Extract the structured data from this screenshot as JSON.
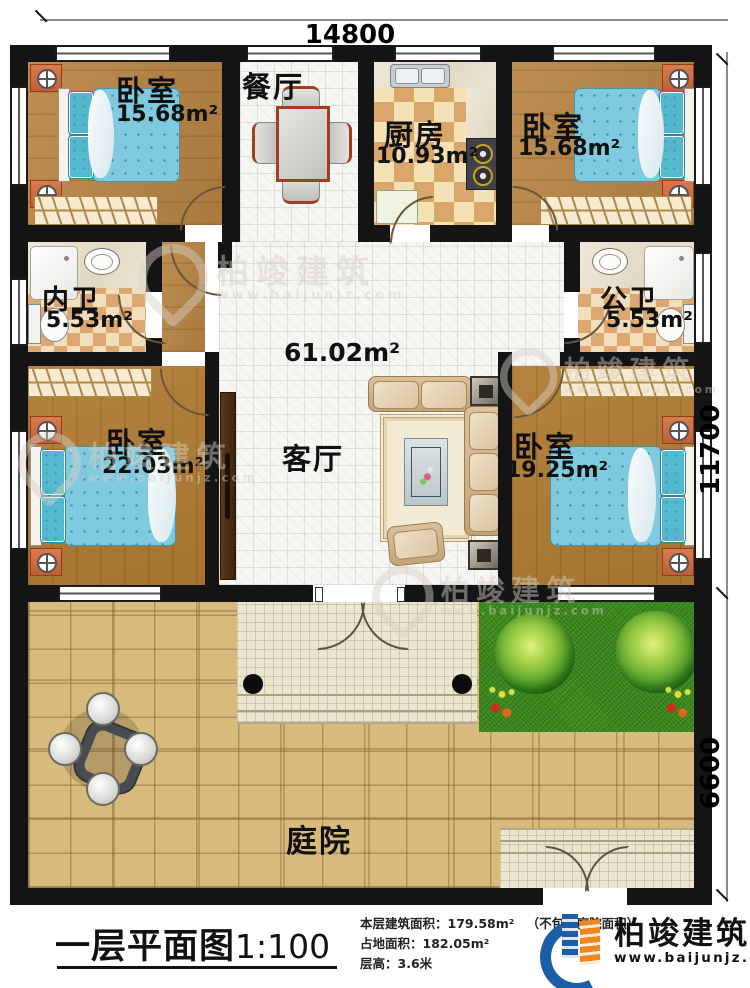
{
  "plan": {
    "title": "一层平面图",
    "scale": "1:100"
  },
  "dimensions": {
    "top_width": "14800",
    "right_upper": "11700",
    "right_lower": "6600"
  },
  "rooms": [
    {
      "id": "bedroom-top-left",
      "label": "卧室",
      "area": "15.68m²"
    },
    {
      "id": "dining-room",
      "label": "餐厅",
      "area": ""
    },
    {
      "id": "kitchen",
      "label": "厨房",
      "area": "10.93m²"
    },
    {
      "id": "bedroom-top-right",
      "label": "卧室",
      "area": "15.68m²"
    },
    {
      "id": "bath-private",
      "label": "内卫",
      "area": "5.53m²"
    },
    {
      "id": "bath-public",
      "label": "公卫",
      "area": "5.53m²"
    },
    {
      "id": "living-room",
      "label": "客厅",
      "area": "61.02m²"
    },
    {
      "id": "bedroom-bottom-left",
      "label": "卧室",
      "area": "22.03m²"
    },
    {
      "id": "bedroom-bottom-right",
      "label": "卧室",
      "area": "19.25m²"
    },
    {
      "id": "courtyard",
      "label": "庭院",
      "area": ""
    }
  ],
  "stats": {
    "floor_area_label": "本层建筑面积：",
    "floor_area_value": "179.58m²",
    "floor_area_note": "（不包含庭院面积）",
    "land_area_label": "占地面积：",
    "land_area_value": "182.05m²",
    "floor_height_label": "层高：",
    "floor_height_value": "3.6米"
  },
  "brand": {
    "name": "柏竣建筑",
    "website": "www.baijunjz.com"
  },
  "watermark": {
    "name": "柏竣建筑",
    "website": "www.baijunjz.com"
  },
  "colors": {
    "wall": "#141414",
    "wood_floor": "#b5833f",
    "tile_floor": "#f6f6f3",
    "checker_dark": "#d9a76c",
    "checker_light": "#f5e2b4",
    "grass": "#3c8a20",
    "stone": "#d8ba7c",
    "mattress": "#7fcadf",
    "nightstand": "#db7b4e",
    "logo_blue": "#1b5ea6",
    "logo_orange": "#f0871f"
  }
}
